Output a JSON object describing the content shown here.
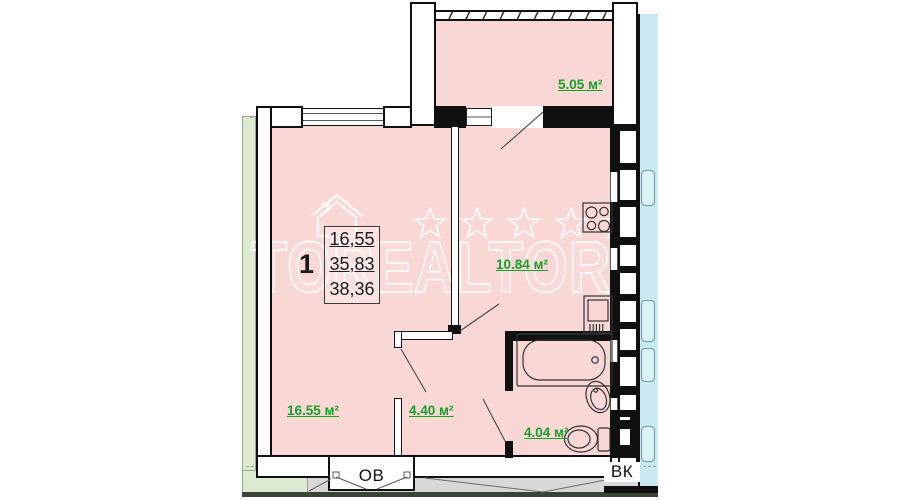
{
  "watermark": {
    "brand": "TOREALTOR"
  },
  "apartment": {
    "rooms_count": "1",
    "living_area": "16,55",
    "total_area": "35,83",
    "total_area_with_balcony": "38,36"
  },
  "room_labels": {
    "balcony": "5.05 м²",
    "kitchen": "10.84 м²",
    "living_room": "16.55 м²",
    "hallway": "4.40 м²",
    "bathroom": "4.04 м²"
  },
  "shafts": {
    "heating_vent": "ОВ",
    "water_sewer": "ВК"
  },
  "icons": {
    "stove-icon": "4-burner cooktop outline",
    "kitchen-unit-icon": "kitchen counter unit outline",
    "bathtub-icon": "bathtub outline",
    "washbasin-icon": "oval washbasin outline",
    "toilet-icon": "toilet with tank outline",
    "house-logo-icon": "outlined house watermark",
    "star-icon": "outlined star watermark"
  },
  "colors": {
    "room_fill": "#f8d7d5",
    "wall": "#101010",
    "area_label_green": "#15a228",
    "adjacent_cyan": "#c9eaf0",
    "adjacent_green": "#dcead4",
    "corridor_gray": "#d8d8d8",
    "watermark": "#ffffff"
  }
}
